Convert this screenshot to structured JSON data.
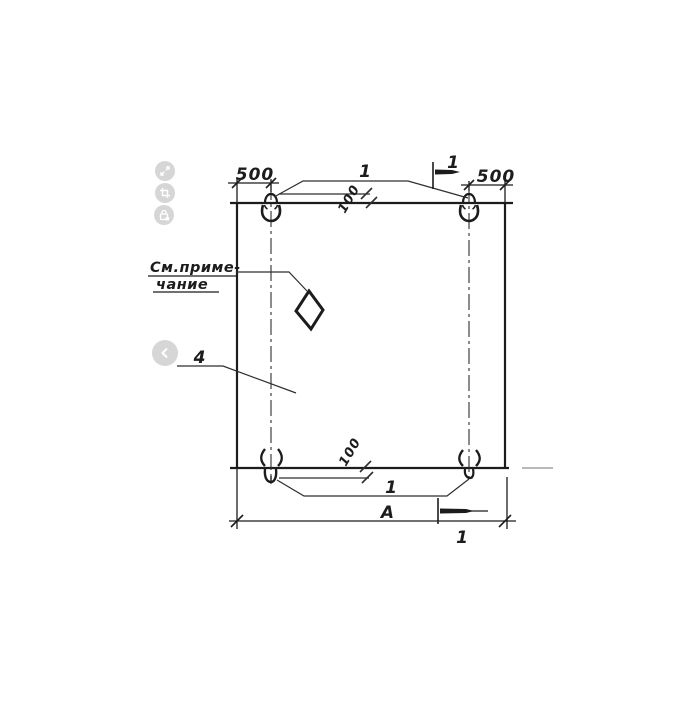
{
  "viewer": {
    "controls": [
      {
        "name": "expand-icon"
      },
      {
        "name": "crop-icon"
      },
      {
        "name": "lock-icon"
      }
    ],
    "prev_button": {
      "name": "chevron-left-icon"
    }
  },
  "drawing": {
    "type": "technical-drawing-plan-view-of-precast-panel-with-lifting-loops",
    "labels": {
      "dim_top_left": "500",
      "dim_top_right": "500",
      "loop_offset_top": "100",
      "loop_offset_bottom": "100",
      "loop_callout_top": "1",
      "loop_callout_bottom": "1",
      "section_mark_top": "1",
      "section_mark_bottom": "1",
      "overall_width": "A",
      "part_callout": "4",
      "note_line1": "См.приме-",
      "note_line2": "чание"
    },
    "colors": {
      "line": "#1c1c1c",
      "thin_line": "#2e2e2e",
      "faint_line": "#b9b9b9",
      "control_grey": "#c9c9c9"
    }
  }
}
